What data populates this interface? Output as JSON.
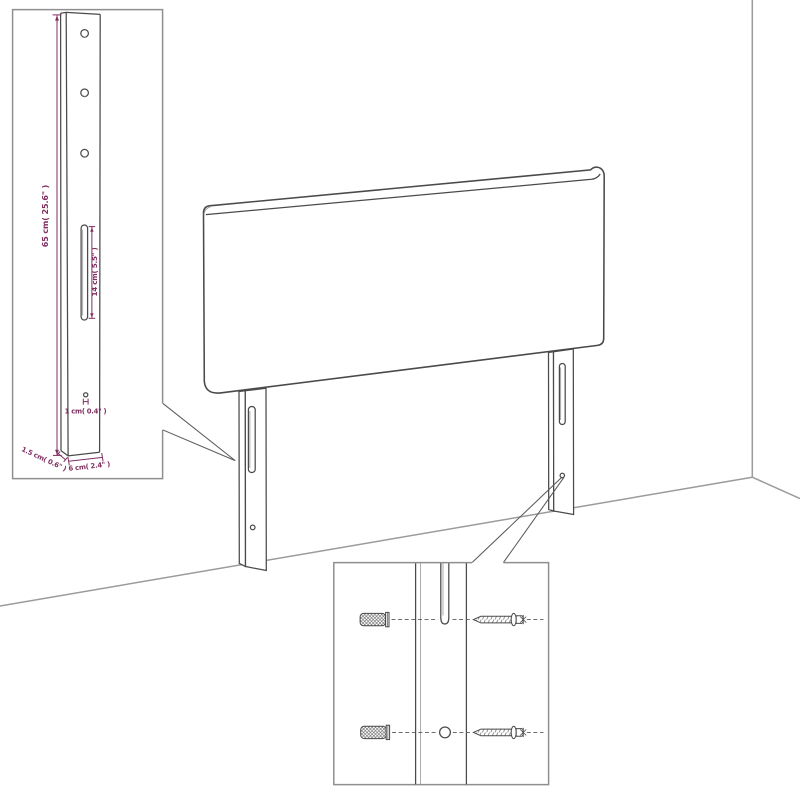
{
  "title": "Headboard wall-mounting dimension diagram",
  "colors": {
    "background": "#ffffff",
    "outline": "#4a4a4a",
    "wall_line": "#9b9b9b",
    "inset_border": "#8f8f8f",
    "leader": "#5a5a5a",
    "dimension": "#802f60",
    "inner_line": "#888888"
  },
  "main_view": {
    "subject": "upholstered headboard with two mounting legs standing against a room corner wall"
  },
  "insets": {
    "post_detail": {
      "name": "leg-post-dimension-callout",
      "dims": {
        "height": "65 cm( 25.6\" )",
        "slot_height": "14 cm( 5.5\" )",
        "hole_diameter": "1 cm( 0.4\" )",
        "depth": "1.5 cm( 0.6\" )",
        "width": "6 cm( 2.4\" )"
      }
    },
    "mounting_detail": {
      "name": "wall-fixing-hardware-callout",
      "icons": {
        "plug": "wall-plug-icon",
        "screw": "screw-icon"
      }
    }
  }
}
